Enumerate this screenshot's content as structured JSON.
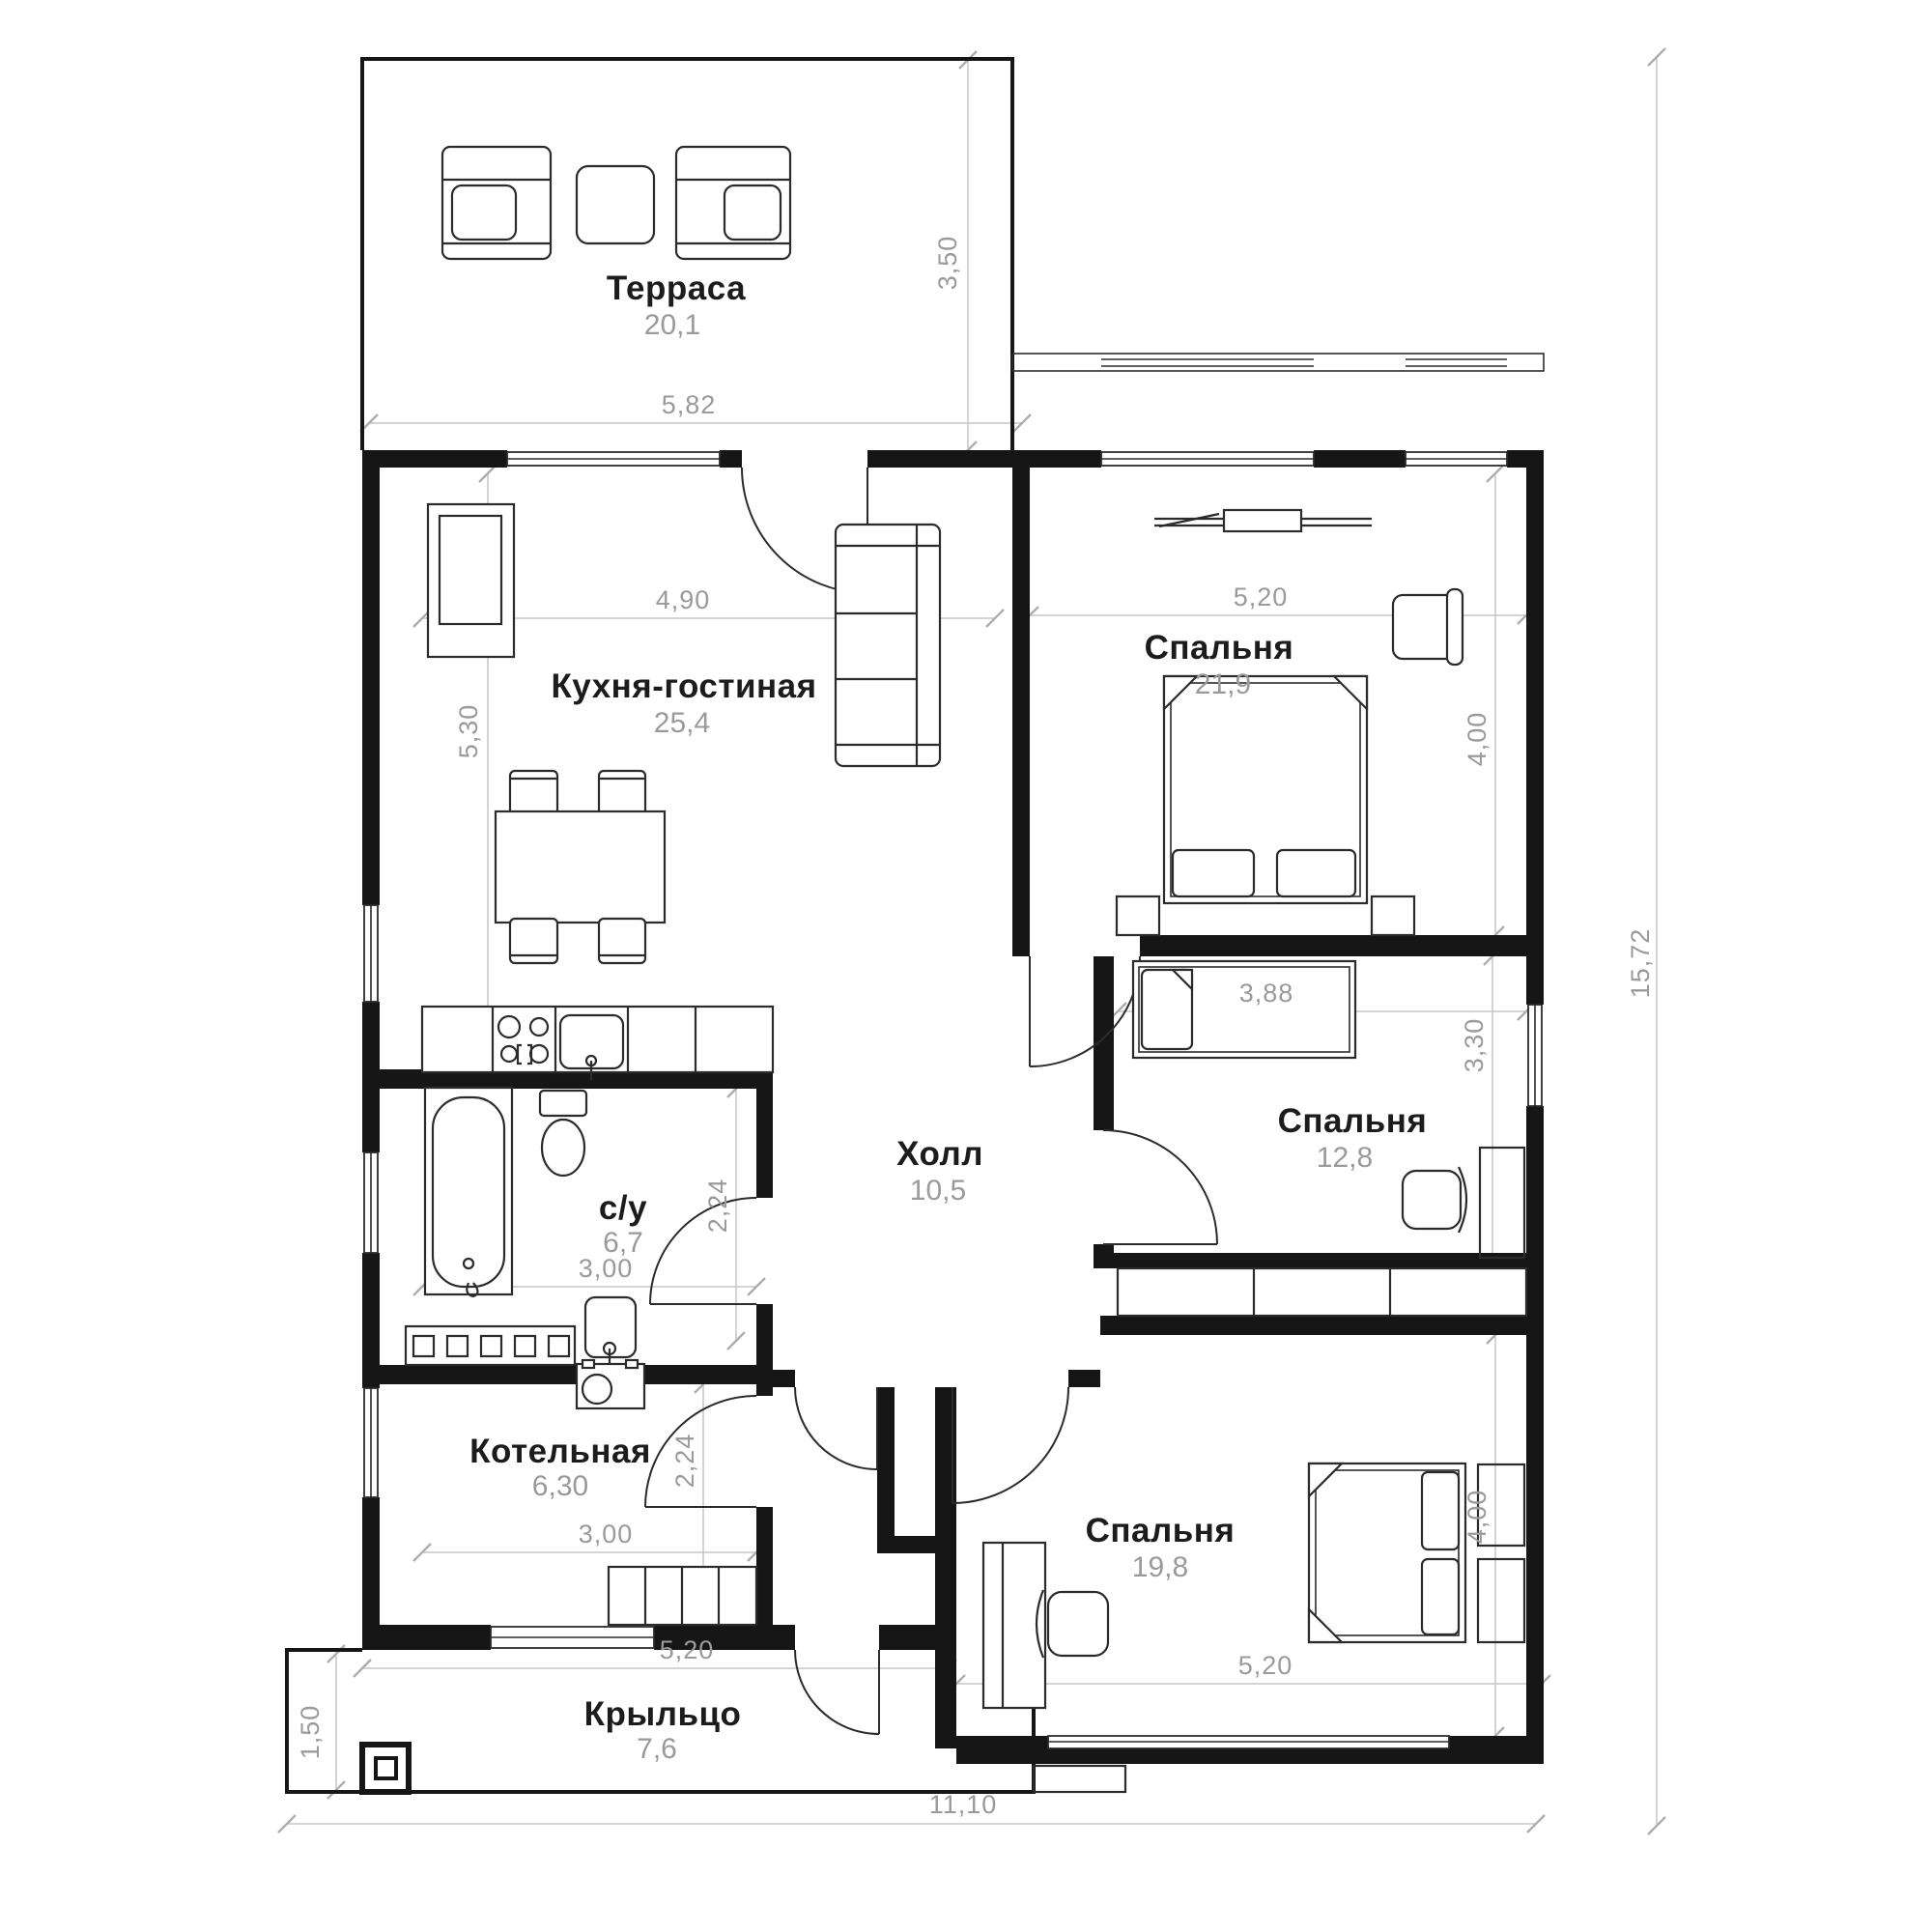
{
  "plan": {
    "title": "Одноэтажный дом — план",
    "rooms": [
      {
        "id": "terrace",
        "name": "Терраса",
        "area": "20,1"
      },
      {
        "id": "kitchen-living",
        "name": "Кухня-гостиная",
        "area": "25,4"
      },
      {
        "id": "bedroom-1",
        "name": "Спальня",
        "area": "21,9"
      },
      {
        "id": "bedroom-2",
        "name": "Спальня",
        "area": "12,8"
      },
      {
        "id": "hall",
        "name": "Холл",
        "area": "10,5"
      },
      {
        "id": "bathroom",
        "name": "с/у",
        "area": "6,7"
      },
      {
        "id": "boiler-room",
        "name": "Котельная",
        "area": "6,30"
      },
      {
        "id": "bedroom-3",
        "name": "Спальня",
        "area": "19,8"
      },
      {
        "id": "porch",
        "name": "Крыльцо",
        "area": "7,6"
      }
    ],
    "dims": [
      "3,50",
      "5,82",
      "4,90",
      "5,30",
      "5,20",
      "4,00",
      "3,88",
      "3,30",
      "2,24",
      "3,00",
      "2,24",
      "3,00",
      "4,00",
      "5,20",
      "5,20",
      "1,50",
      "11,10",
      "15,72"
    ],
    "colors": {
      "wall": "#161616",
      "furniture_line": "#2b2b2b",
      "dim_text": "#9a9a9a",
      "dim_line": "#c6c6c6",
      "room_name": "#1c1c1c",
      "background": "#ffffff"
    }
  }
}
